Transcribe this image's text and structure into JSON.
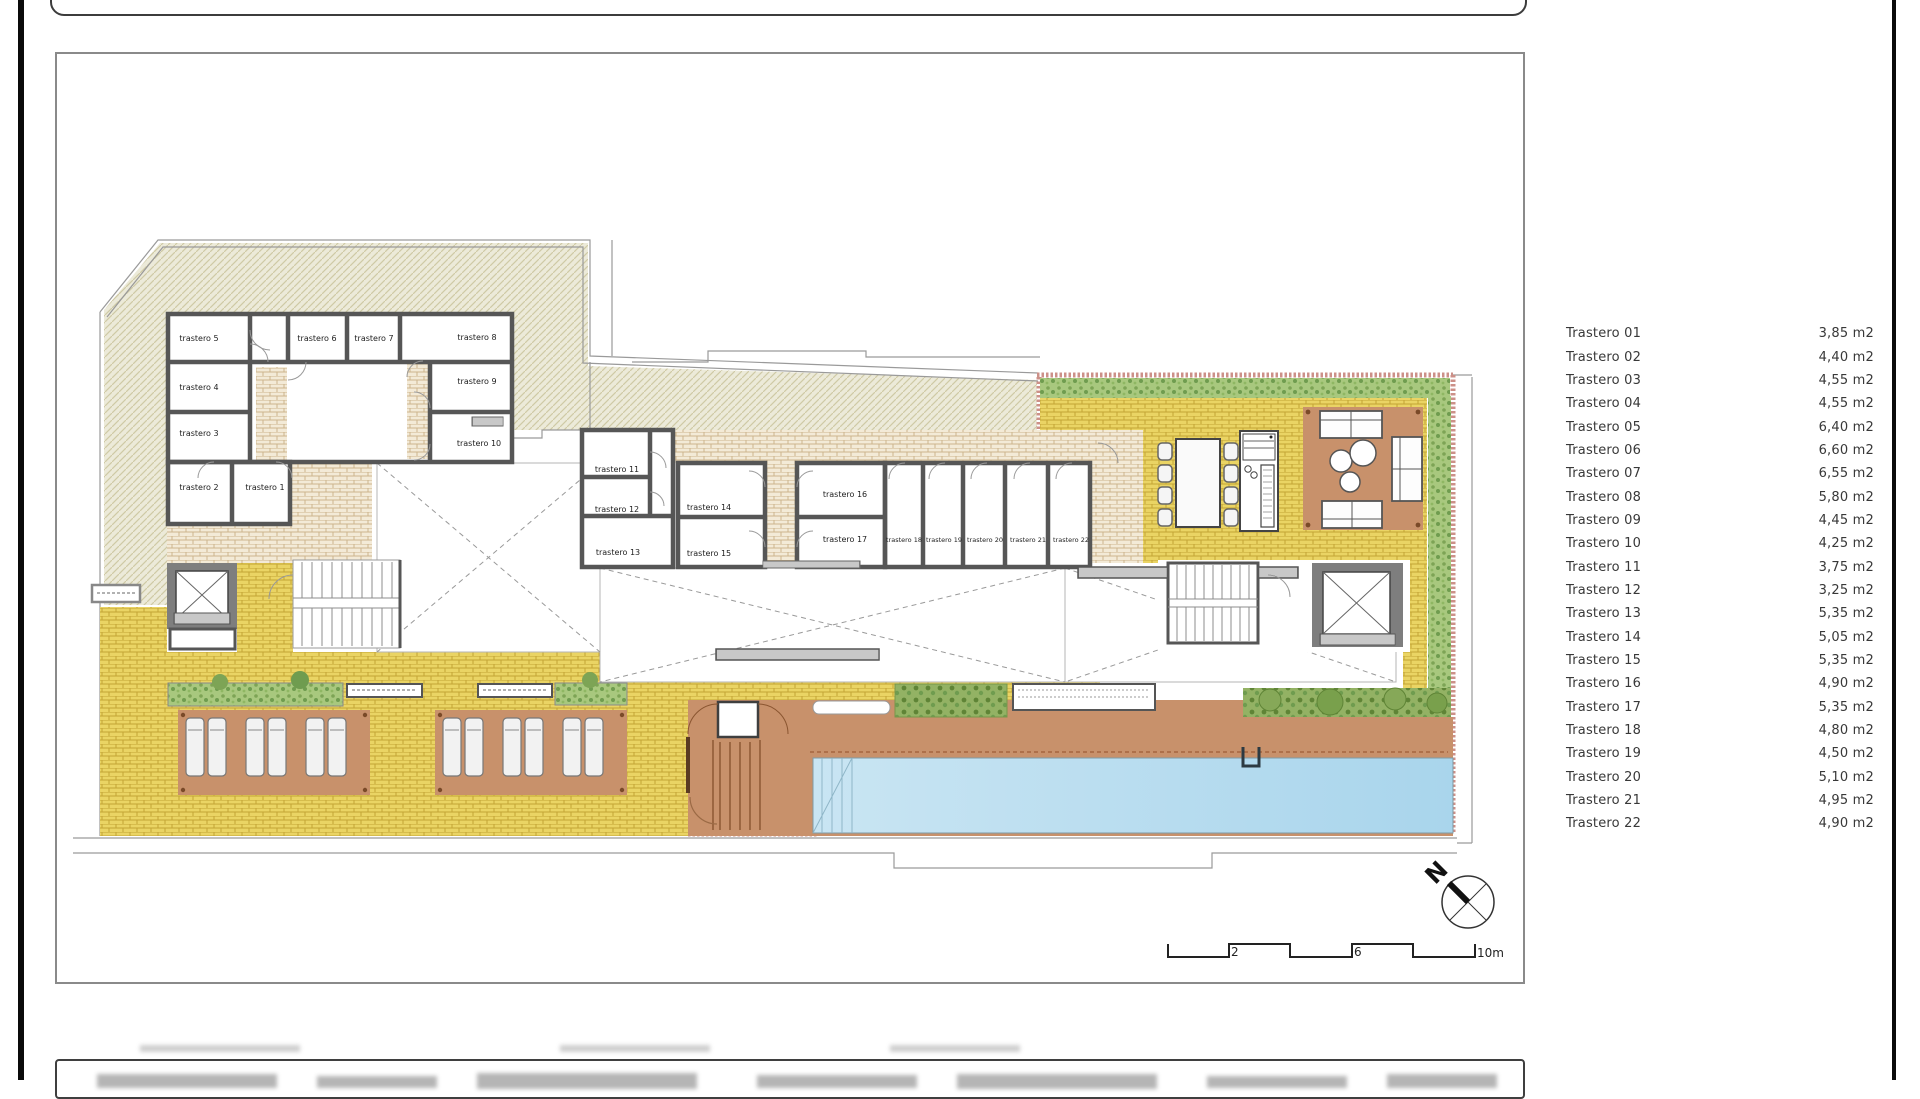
{
  "legend": {
    "items": [
      {
        "name": "Trastero 01",
        "area": "3,85 m2"
      },
      {
        "name": "Trastero 02",
        "area": "4,40 m2"
      },
      {
        "name": "Trastero 03",
        "area": "4,55 m2"
      },
      {
        "name": "Trastero 04",
        "area": "4,55 m2"
      },
      {
        "name": "Trastero 05",
        "area": "6,40 m2"
      },
      {
        "name": "Trastero 06",
        "area": "6,60 m2"
      },
      {
        "name": "Trastero 07",
        "area": "6,55 m2"
      },
      {
        "name": "Trastero 08",
        "area": "5,80 m2"
      },
      {
        "name": "Trastero 09",
        "area": "4,45 m2"
      },
      {
        "name": "Trastero 10",
        "area": "4,25 m2"
      },
      {
        "name": "Trastero 11",
        "area": "3,75 m2"
      },
      {
        "name": "Trastero 12",
        "area": "3,25 m2"
      },
      {
        "name": "Trastero 13",
        "area": "5,35 m2"
      },
      {
        "name": "Trastero 14",
        "area": "5,05 m2"
      },
      {
        "name": "Trastero 15",
        "area": "5,35 m2"
      },
      {
        "name": "Trastero 16",
        "area": "4,90 m2"
      },
      {
        "name": "Trastero 17",
        "area": "5,35 m2"
      },
      {
        "name": "Trastero 18",
        "area": "4,80 m2"
      },
      {
        "name": "Trastero 19",
        "area": "4,50 m2"
      },
      {
        "name": "Trastero 20",
        "area": "5,10 m2"
      },
      {
        "name": "Trastero 21",
        "area": "4,95 m2"
      },
      {
        "name": "Trastero 22",
        "area": "4,90 m2"
      }
    ]
  },
  "plan": {
    "rooms": [
      {
        "label": "trastero 1"
      },
      {
        "label": "trastero 2"
      },
      {
        "label": "trastero 3"
      },
      {
        "label": "trastero 4"
      },
      {
        "label": "trastero 5"
      },
      {
        "label": "trastero 6"
      },
      {
        "label": "trastero 7"
      },
      {
        "label": "trastero 8"
      },
      {
        "label": "trastero 9"
      },
      {
        "label": "trastero 10"
      },
      {
        "label": "trastero 11"
      },
      {
        "label": "trastero 12"
      },
      {
        "label": "trastero 13"
      },
      {
        "label": "trastero 14"
      },
      {
        "label": "trastero 15"
      },
      {
        "label": "trastero 16"
      },
      {
        "label": "trastero 17"
      },
      {
        "label": "trastero 18"
      },
      {
        "label": "trastero 19"
      },
      {
        "label": "trastero 20"
      },
      {
        "label": "trastero 21"
      },
      {
        "label": "trastero 22"
      }
    ]
  },
  "compass": {
    "label": "N"
  },
  "scale_bar": {
    "labels": [
      "2",
      "6",
      "10m"
    ]
  },
  "colors": {
    "hatch_bg": "#ecead9",
    "hatch_line": "#cfc9a5",
    "paving_yellow": "#ead464",
    "paving_cream": "#f3ead7",
    "deck_brown": "#c8916b",
    "pool_blue": "#b9dcee",
    "hedge_green": "#a8c87e",
    "planter_pink": "#cc9088",
    "wall_gray": "#565656"
  }
}
